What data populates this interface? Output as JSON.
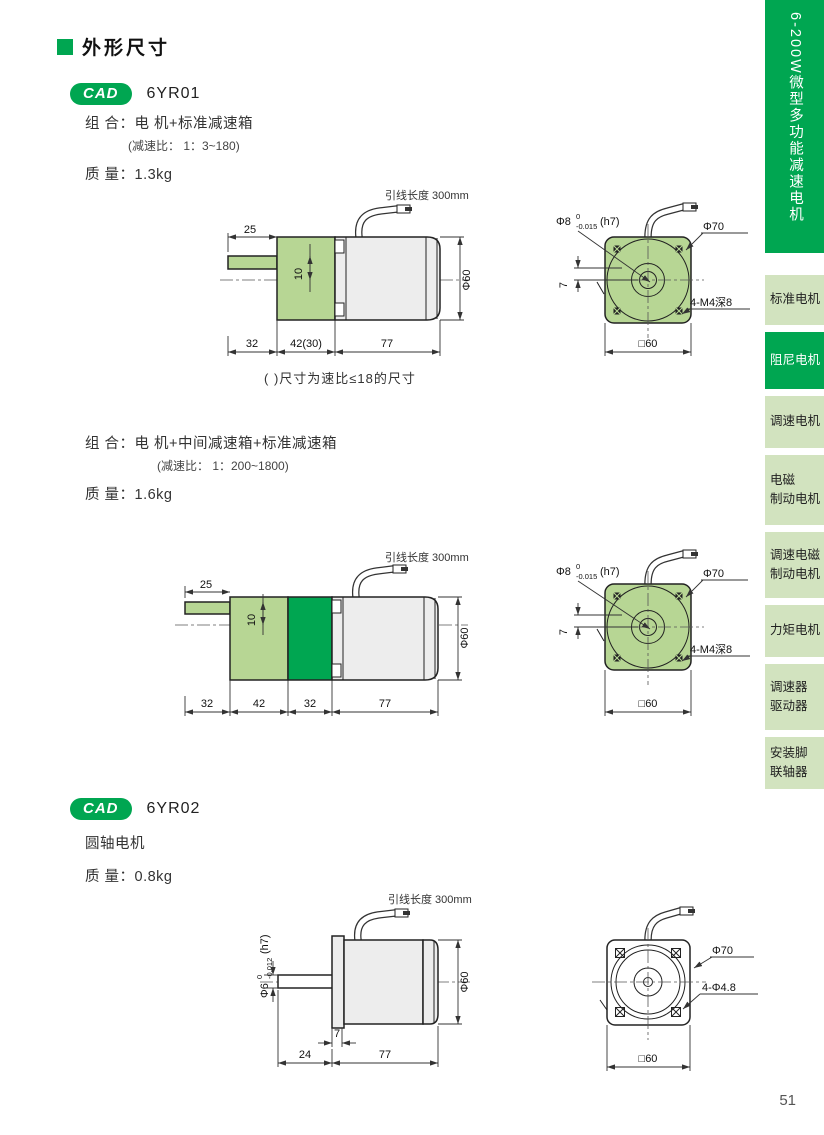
{
  "page": {
    "title": "外形尺寸",
    "page_number": "51"
  },
  "colors": {
    "accent_green": "#00a651",
    "tab_light_green": "#d2e3bf",
    "drawing_light_green": "#b7d694",
    "motor_gray": "#ededed"
  },
  "sidebar": {
    "header": "6-200W微型多功能减速电机",
    "items": [
      {
        "line1": "标准电机"
      },
      {
        "line1": "阻尼电机",
        "active": true
      },
      {
        "line1": "调速电机"
      },
      {
        "line1": "电磁",
        "line2": "制动电机"
      },
      {
        "line1": "调速电磁",
        "line2": "制动电机"
      },
      {
        "line1": "力矩电机"
      },
      {
        "line1": "调速器",
        "line2": "驱动器"
      },
      {
        "line1": "安装脚",
        "line2": "联轴器"
      }
    ]
  },
  "sections": {
    "s1": {
      "badge": "CAD",
      "model": "6YR01",
      "combo": "组 合：电 机+标准减速箱",
      "ratio": "(减速比： 1：3~180)",
      "weight": "质 量：1.3kg",
      "note": "( )尺寸为速比≤18的尺寸",
      "drawing": {
        "lead": "引线长度 300mm",
        "d25": "25",
        "d10": "10",
        "d32": "32",
        "d42": "42(30)",
        "d77": "77",
        "dia60": "Φ60",
        "shaft_dia": "Φ8",
        "tol_sup": "0",
        "tol_sub": "-0.015",
        "fit": "(h7)",
        "d7": "7",
        "dia70": "Φ70",
        "holes": "4-M4深8",
        "square": "□60"
      }
    },
    "s2": {
      "combo": "组 合：电 机+中间减速箱+标准减速箱",
      "ratio": "(减速比： 1：200~1800)",
      "weight": "质 量：1.6kg",
      "drawing": {
        "lead": "引线长度 300mm",
        "d25": "25",
        "d10": "10",
        "d32a": "32",
        "d42": "42",
        "d32b": "32",
        "d77": "77",
        "dia60": "Φ60",
        "shaft_dia": "Φ8",
        "tol_sup": "0",
        "tol_sub": "-0.015",
        "fit": "(h7)",
        "d7": "7",
        "dia70": "Φ70",
        "holes": "4-M4深8",
        "square": "□60"
      }
    },
    "s3": {
      "badge": "CAD",
      "model": "6YR02",
      "type": "圆轴电机",
      "weight": "质 量：0.8kg",
      "drawing": {
        "lead": "引线长度 300mm",
        "shaft_dia": "Φ6",
        "tol_sup": "0",
        "tol_sub": "-0.012",
        "fit": "(h7)",
        "d7": "7",
        "d24": "24",
        "d77": "77",
        "dia60": "Φ60",
        "dia70": "Φ70",
        "holes": "4-Φ4.8",
        "square": "□60"
      }
    }
  }
}
